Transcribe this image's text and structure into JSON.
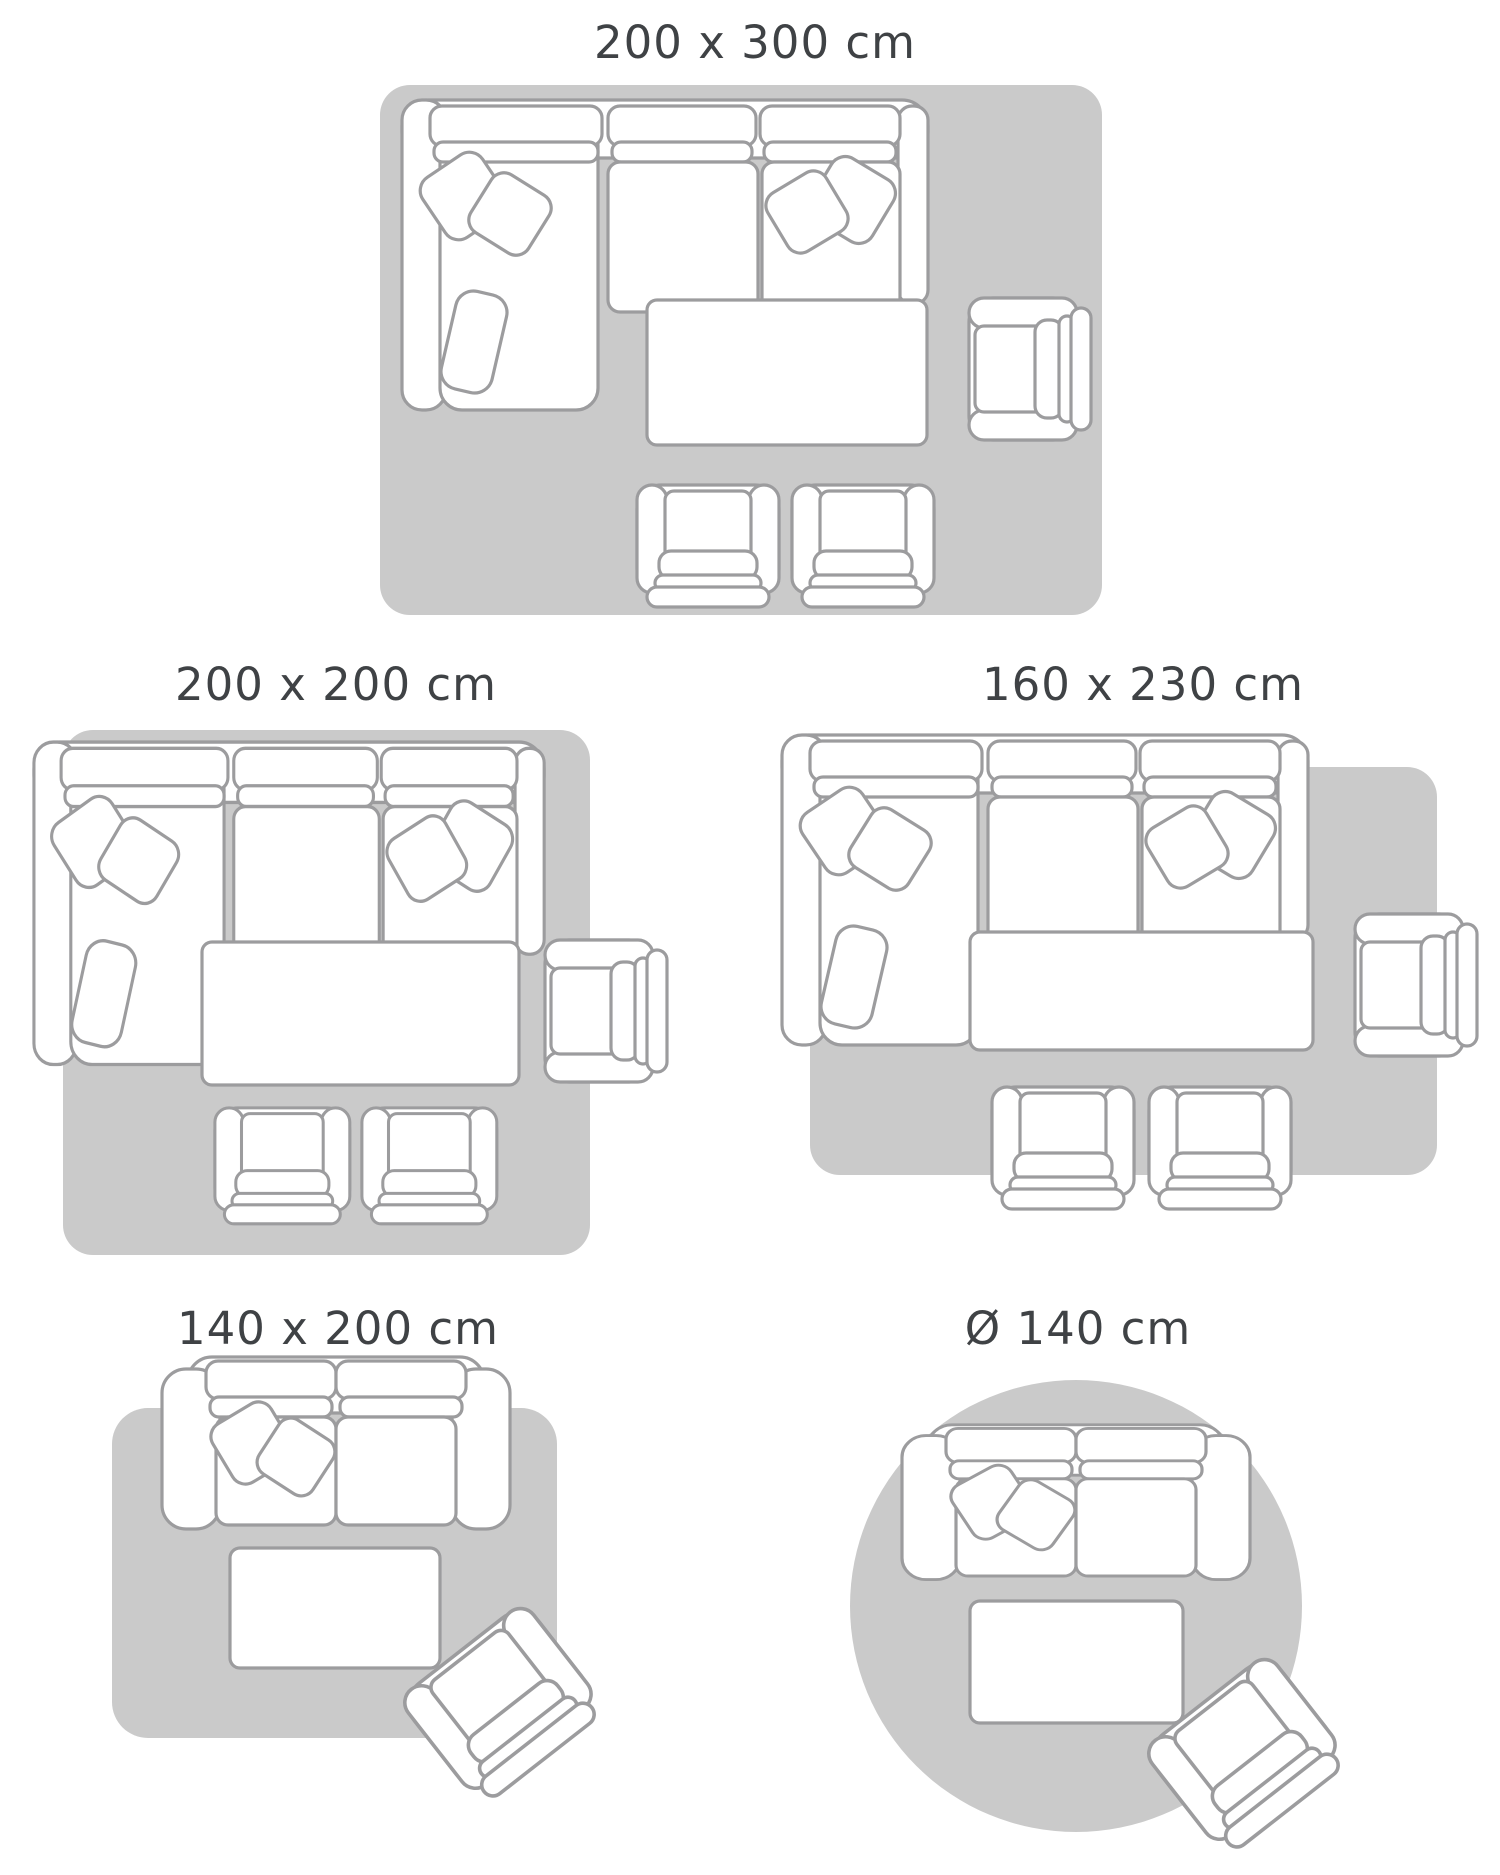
{
  "styles": {
    "background_color": "#ffffff",
    "rug_color": "#cacaca",
    "outline_color": "#9c9c9e",
    "furniture_fill": "#ffffff",
    "label_color": "#3f4245"
  },
  "guide": {
    "type": "rug-size-guide",
    "layouts": [
      {
        "label": "200 x 300 cm",
        "rug_shape": "rectangle",
        "rug_size_cm": "200 x 300",
        "furniture": [
          "corner-sofa-with-cushions",
          "coffee-table",
          "side-armchair",
          "armchair",
          "armchair"
        ]
      },
      {
        "label": "200 x 200 cm",
        "rug_shape": "rectangle",
        "rug_size_cm": "200 x 200",
        "furniture": [
          "corner-sofa-with-cushions",
          "coffee-table",
          "side-armchair",
          "armchair",
          "armchair"
        ]
      },
      {
        "label": "160 x 230 cm",
        "rug_shape": "rectangle",
        "rug_size_cm": "160 x 230",
        "furniture": [
          "corner-sofa-with-cushions",
          "coffee-table",
          "side-armchair",
          "armchair",
          "armchair"
        ]
      },
      {
        "label": "140 x 200 cm",
        "rug_shape": "rectangle",
        "rug_size_cm": "140 x 200",
        "furniture": [
          "two-seater-sofa-with-cushions",
          "coffee-table",
          "angled-armchair"
        ]
      },
      {
        "label": "Ø 140 cm",
        "rug_shape": "circle",
        "rug_size_cm": "Ø 140",
        "furniture": [
          "two-seater-sofa-with-cushions",
          "coffee-table",
          "angled-armchair"
        ]
      }
    ]
  }
}
